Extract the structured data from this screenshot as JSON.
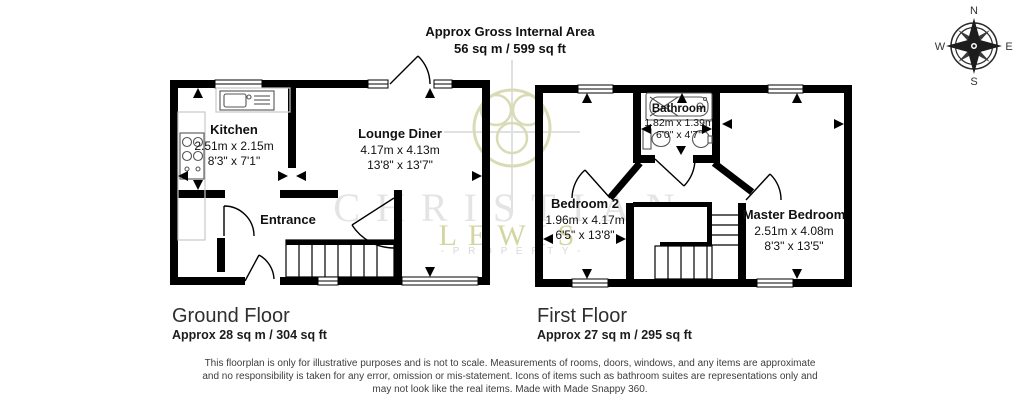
{
  "header": {
    "title_line1": "Approx Gross Internal Area",
    "title_line2": "56 sq m / 599 sq ft"
  },
  "compass": {
    "n": "N",
    "e": "E",
    "s": "S",
    "w": "W"
  },
  "ground_floor": {
    "label": "Ground Floor",
    "area": "Approx 28 sq m / 304 sq ft",
    "kitchen": {
      "name": "Kitchen",
      "metric": "2.51m x 2.15m",
      "imperial": "8'3\" x 7'1\""
    },
    "lounge": {
      "name": "Lounge Diner",
      "metric": "4.17m x 4.13m",
      "imperial": "13'8\" x 13'7\""
    },
    "entrance": {
      "name": "Entrance"
    }
  },
  "first_floor": {
    "label": "First Floor",
    "area": "Approx 27 sq m / 295 sq ft",
    "bathroom": {
      "name": "Bathroom",
      "metric": "1.82m x 1.39m",
      "imperial": "6'0\" x 4'7\""
    },
    "bedroom2": {
      "name": "Bedroom 2",
      "metric": "1.96m x 4.17m",
      "imperial": "6'5\" x 13'8\""
    },
    "master": {
      "name": "Master Bedroom",
      "metric": "2.51m x 4.08m",
      "imperial": "8'3\" x 13'5\""
    }
  },
  "watermark": {
    "brand_line1": "CHRISTIAN",
    "brand_line2": "LEWIS",
    "brand_line3": "- P R O P E R T Y -"
  },
  "footer": {
    "disclaimer_line1": "This floorplan is only for illustrative purposes and is not to scale. Measurements of rooms, doors, windows, and any items are approximate",
    "disclaimer_line2": "and no responsibility is taken for any error, omission or mis-statement. Icons of items such as bathroom suites are representations only and",
    "disclaimer_line3": "may not look like the real items. Made with Made Snappy 360."
  },
  "colors": {
    "wall": "#000000",
    "watermark_gray": "#e4e4e4",
    "watermark_olive": "#d4d6a2"
  }
}
